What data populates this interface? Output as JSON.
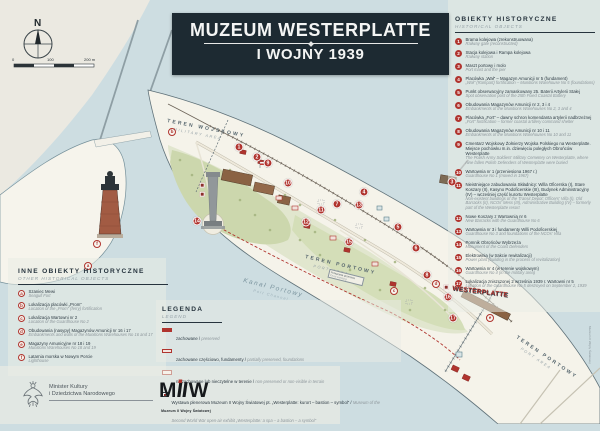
{
  "title": {
    "line1": "MUZEUM WESTERPLATTE",
    "line2": "I WOJNY 1939"
  },
  "compass": {
    "north_label": "N"
  },
  "scalebar": {
    "t0": "0",
    "t100": "100",
    "t200": "200 m"
  },
  "sidebar": {
    "heading_pl": "OBIEKTY HISTORYCZNE",
    "heading_en": "HISTORICAL OBJECTS",
    "items": [
      {
        "num": "1",
        "pl": "Brama kolejowa (zrekonstruowana)",
        "en": "Railway gate (reconstructed)"
      },
      {
        "num": "2",
        "pl": "Stacja kolejowa i Rampa kolejowa",
        "en": "Railway station"
      },
      {
        "num": "3",
        "pl": "Maszt portowy i molo",
        "en": "Port mast and the pier"
      },
      {
        "num": "4",
        "pl": "Placówka „Wał” – Magazyn Amunicji nr 5 (fundament)",
        "en": "„Wał” (Rampart) fortification – Munitions Warehouse No 5 (foundations)"
      },
      {
        "num": "5",
        "pl": "Punkt obserwacyjny zamaskowany 25. Baterii Artylerii Stałej",
        "en": "Spot observation post of the 25th Fixed Coastal Battery"
      },
      {
        "num": "6",
        "pl": "Obudowania Magazynów Amunicji nr 2, 3 i 4",
        "en": "Embankments of the Munitions Warehouses No 2, 3 and 4"
      },
      {
        "num": "7",
        "pl": "Placówka „Fort” – dawny schron komendanta artylerii nadbrzeżnej",
        "en": "„Fort” fortification – former coastal artillery command shelter"
      },
      {
        "num": "8",
        "pl": "Obudowania Magazynów Amunicji nr 10 i 11",
        "en": "Embankments of the Munitions Warehouses No 10 and 11"
      },
      {
        "num": "9",
        "pl": "Cmentarz Wojskowy Żołnierzy Wojska Polskiego na Westerplatte. Miejsce pochówku m.in. dziewięciu poległych Obrońców Westerplatte",
        "en": "The Polish Army Soldiers' Military Cemetery on Westerplatte, where nine fallen Polish Defenders of Westerplatte were buried"
      },
      {
        "num": "10",
        "pl": "Wartownia nr 1 (przeniesiona 1967 r.)",
        "en": "Guardhouse No 1 (moved in 1967)"
      },
      {
        "num": "11",
        "pl": "Nieistniejące zabudowania Składnicy: Willa Oficerska (I), Stare Koszary (II), Kasyno Podoficerskie (III), Budynek Administracyjny (IV) – wcześniej część kurortu Westerplatte",
        "en": "Non-existent buildings of the Transit Depot: Officers' Villa (I), Old Barracks (II), NCOs' Mess (III), Administrative Building (IV) – formerly part of the Westerplatte resort"
      },
      {
        "num": "12",
        "pl": "Nowe Koszary z Wartownią nr 6",
        "en": "New Barracks with the Guardhouse No 6"
      },
      {
        "num": "13",
        "pl": "Wartownia nr 3 i fundamenty Willi Podoficerskiej",
        "en": "Guardhouse No 3 and foundations of the NCOs' Villa"
      },
      {
        "num": "14",
        "pl": "Pomnik Obrońców Wybrzeża",
        "en": "Monument of the Coast Defenders"
      },
      {
        "num": "15",
        "pl": "Elektrownia (w trakcie rewitalizacji)",
        "en": "Power plant (building in the process of revitalization)"
      },
      {
        "num": "16",
        "pl": "Wartownia nr 4 (w terenie wojskowym)",
        "en": "Guardhouse No 4 (in the military area)"
      },
      {
        "num": "17",
        "pl": "Lokalizacja zniszczonej 2 września 1939 r. Wartowni nr 5",
        "en": "Location of the Guardhouse No 5 destroyed on September 2, 1939"
      }
    ]
  },
  "other_objects": {
    "heading_pl": "INNE OBIEKTY HISTORYCZNE",
    "heading_en": "OTHER HISTORICAL OBJECTS",
    "items": [
      {
        "letter": "a",
        "pl": "Szaniec Mewi",
        "en": "Seagull Fort"
      },
      {
        "letter": "b",
        "pl": "Lokalizacja placówki „Prom”",
        "en": "Location of the „Prom” (ferry) fortification"
      },
      {
        "letter": "c",
        "pl": "Lokalizacja Wartowni nr 2",
        "en": "Location of the Guardhouse No 2"
      },
      {
        "letter": "d",
        "pl": "Obudowania (nasypy) Magazynów Amunicji nr 16 i 17",
        "en": "Embankments and walls of the Munitions Warehouses No 16 and 17"
      },
      {
        "letter": "e",
        "pl": "Magazyny Amunicyjne nr 18 i 19",
        "en": "Munitions Warehouses No 18 and 19"
      },
      {
        "letter": "f",
        "pl": "Latarnia morska w Nowym Porcie",
        "en": "Lighthouse"
      }
    ]
  },
  "legend": {
    "heading_pl": "LEGENDA",
    "heading_en": "LEGEND",
    "items": [
      {
        "swatch": "solid",
        "pl": "zachowane / ",
        "en": "preserved"
      },
      {
        "swatch": "part",
        "pl": "zachowane częściowo, fundamenty / ",
        "en": "partially preserved, foundations"
      },
      {
        "swatch": "gone",
        "pl": "niezachowane lub nieczytelne w terenie / ",
        "en": "non-preserved or non-visible in terrain"
      },
      {
        "swatch": "sq",
        "pl": "Wystawa plenerowa Muzeum II Wojny Światowej pt. „Westerplatte: kurort – bastion – symbol” / ",
        "en": "Museum of the Second World War open-air exhibit „Westerplatte: a spa – a bastion – a symbol”"
      }
    ]
  },
  "map": {
    "labels": {
      "military_pl": "TEREN WOJSKOWY",
      "military_en": "MILITARY AREA",
      "port1_pl": "TEREN PORTOWY",
      "port1_en": "PORT AREA",
      "port2_pl": "TEREN PORTOWY",
      "port2_en": "PORT AREA",
      "channel_pl": "Kanał Portowy",
      "channel_en": "Port Channel",
      "sign": "WESTERPLATTE",
      "ferry_pl": "Przeprawa promowa",
      "ferry_en": "Ferry crossing",
      "credit": "Muzeum II Wojny Światowej"
    },
    "markers": [
      {
        "n": "1",
        "x": 239,
        "y": 147
      },
      {
        "n": "2",
        "x": 257,
        "y": 157
      },
      {
        "n": "3",
        "x": 452,
        "y": 182
      },
      {
        "n": "4",
        "x": 364,
        "y": 192
      },
      {
        "n": "5",
        "x": 398,
        "y": 227
      },
      {
        "n": "6",
        "x": 416,
        "y": 248
      },
      {
        "n": "7",
        "x": 337,
        "y": 204
      },
      {
        "n": "8",
        "x": 427,
        "y": 275
      },
      {
        "n": "9",
        "x": 268,
        "y": 163
      },
      {
        "n": "10",
        "x": 288,
        "y": 183
      },
      {
        "n": "11",
        "x": 321,
        "y": 210
      },
      {
        "n": "12",
        "x": 306,
        "y": 222
      },
      {
        "n": "13",
        "x": 359,
        "y": 205
      },
      {
        "n": "14",
        "x": 197,
        "y": 221
      },
      {
        "n": "15",
        "x": 349,
        "y": 242
      },
      {
        "n": "16",
        "x": 448,
        "y": 297
      },
      {
        "n": "17",
        "x": 453,
        "y": 318
      }
    ],
    "letter_markers": [
      {
        "l": "a",
        "x": 88,
        "y": 266
      },
      {
        "l": "b",
        "x": 172,
        "y": 132
      },
      {
        "l": "c",
        "x": 394,
        "y": 291
      },
      {
        "l": "d",
        "x": 436,
        "y": 284
      },
      {
        "l": "e",
        "x": 490,
        "y": 318
      },
      {
        "l": "f",
        "x": 97,
        "y": 244
      }
    ],
    "exhibit_squares": [
      {
        "x": 202,
        "y": 185
      },
      {
        "x": 202,
        "y": 194
      },
      {
        "x": 446,
        "y": 287
      }
    ]
  },
  "footer": {
    "ministry_line1": "Minister Kultury",
    "ministry_line2": "i Dziedzictwa Narodowego",
    "miw_caption": "Muzeum II Wojny Światowej"
  },
  "colors": {
    "accent_red": "#b0342e",
    "navy": "#26333d",
    "water": "#cddde1",
    "paper": "#ebe9e1",
    "land": "#f5f3ea",
    "museum_green": "#ccd7ad",
    "building_brown": "#8a6243",
    "banner_bg": "#1d2a32"
  }
}
